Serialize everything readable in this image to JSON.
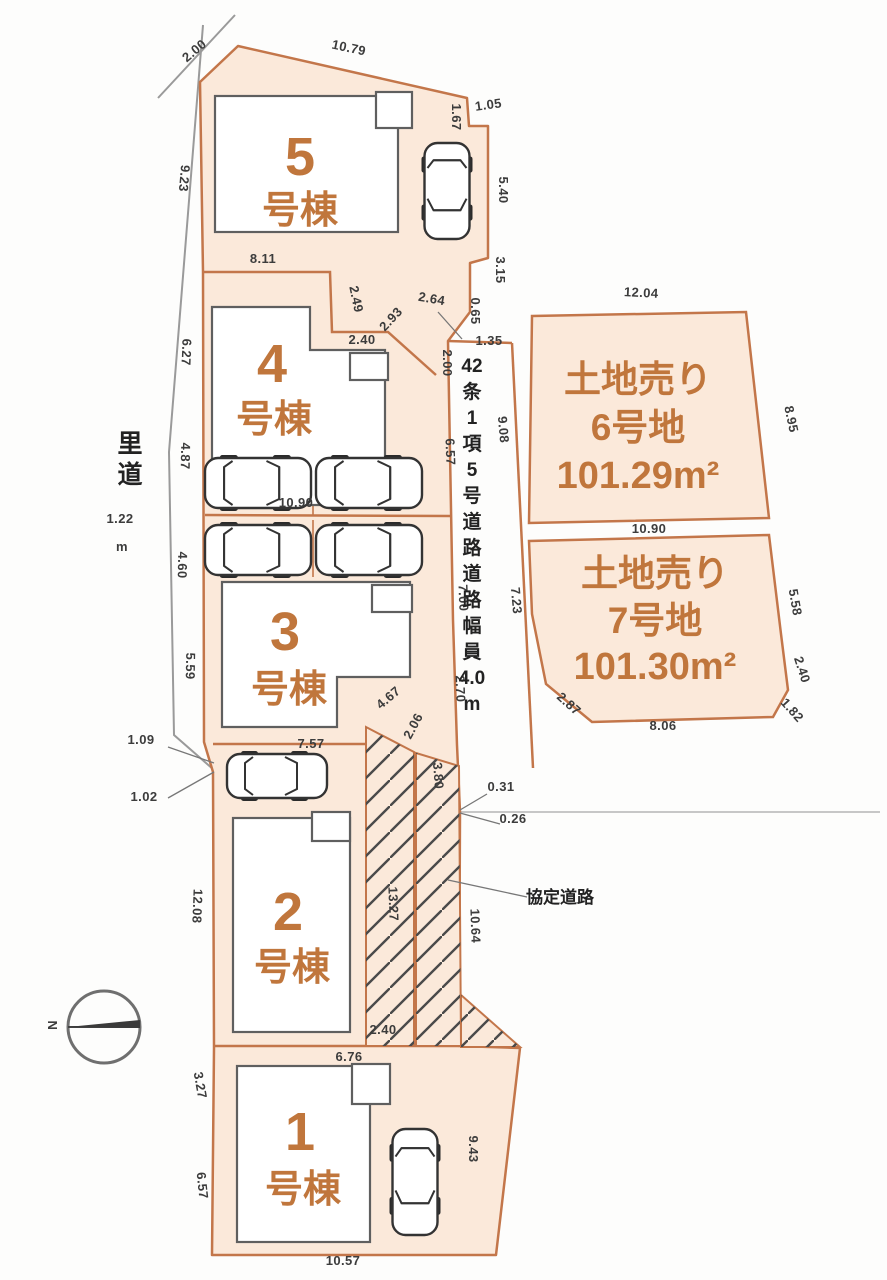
{
  "plan": {
    "title": "土地区画図",
    "north_label": "N",
    "colors": {
      "parcel_fill": "#fbe9da",
      "parcel_stroke": "#c3764a",
      "building_stroke": "#5f5f5f",
      "dim_text": "#3c3c3c",
      "lot_text": "#c0763c",
      "hatch_line": "#4a4a4a",
      "gray_line": "#9a9a9a"
    }
  },
  "satodou": {
    "chars": [
      "里",
      "道"
    ],
    "width_value": "1.22",
    "unit": "m"
  },
  "road": {
    "chars": [
      "42",
      "条",
      "1",
      "項",
      "5",
      "号",
      "道",
      "路",
      "道",
      "路",
      "幅",
      "員",
      "4.0",
      "m"
    ],
    "x": 472,
    "y_start": 372,
    "step": 26
  },
  "kyotei": {
    "label": "協定道路",
    "x": 560,
    "y": 903
  },
  "buildings": [
    {
      "num": "5",
      "suffix": "号棟",
      "nx": 300,
      "ny": 175,
      "sx": 300,
      "sy": 223
    },
    {
      "num": "4",
      "suffix": "号棟",
      "nx": 272,
      "ny": 382,
      "sx": 274,
      "sy": 432
    },
    {
      "num": "3",
      "suffix": "号棟",
      "nx": 285,
      "ny": 650,
      "sx": 289,
      "sy": 702
    },
    {
      "num": "2",
      "suffix": "号棟",
      "nx": 288,
      "ny": 930,
      "sx": 292,
      "sy": 980
    },
    {
      "num": "1",
      "suffix": "号棟",
      "nx": 300,
      "ny": 1150,
      "sx": 303,
      "sy": 1202
    }
  ],
  "land_lots": [
    {
      "name": "lot-6",
      "lines": [
        "土地売り",
        "6号地",
        "101.29m²"
      ],
      "cx": 638,
      "ys": [
        392,
        440,
        488
      ]
    },
    {
      "name": "lot-7",
      "lines": [
        "土地売り",
        "7号地",
        "101.30m²"
      ],
      "cx": 655,
      "ys": [
        586,
        633,
        679
      ]
    }
  ],
  "dimensions": [
    {
      "t": "2.00",
      "x": 197,
      "y": 54,
      "r": -40
    },
    {
      "t": "10.79",
      "x": 348,
      "y": 52,
      "r": 12
    },
    {
      "t": "1.67",
      "x": 452,
      "y": 117,
      "r": 90
    },
    {
      "t": "1.05",
      "x": 489,
      "y": 109,
      "r": -8
    },
    {
      "t": "5.40",
      "x": 499,
      "y": 190,
      "r": 90
    },
    {
      "t": "3.15",
      "x": 496,
      "y": 270,
      "r": 90
    },
    {
      "t": "0.65",
      "x": 471,
      "y": 311,
      "r": 90
    },
    {
      "t": "2.64",
      "x": 431,
      "y": 303,
      "r": 10
    },
    {
      "t": "1.35",
      "x": 489,
      "y": 345,
      "r": 0
    },
    {
      "t": "2.00",
      "x": 443,
      "y": 363,
      "r": 90
    },
    {
      "t": "8.11",
      "x": 263,
      "y": 263,
      "r": 0
    },
    {
      "t": "2.49",
      "x": 352,
      "y": 300,
      "r": 78
    },
    {
      "t": "2.93",
      "x": 394,
      "y": 322,
      "r": -47
    },
    {
      "t": "2.40",
      "x": 362,
      "y": 344,
      "r": 0
    },
    {
      "t": "9.23",
      "x": 180,
      "y": 178,
      "r": 95
    },
    {
      "t": "6.27",
      "x": 182,
      "y": 352,
      "r": 92
    },
    {
      "t": "4.87",
      "x": 181,
      "y": 456,
      "r": 91
    },
    {
      "t": "4.60",
      "x": 178,
      "y": 565,
      "r": 91
    },
    {
      "t": "5.59",
      "x": 186,
      "y": 666,
      "r": 91
    },
    {
      "t": "10.90",
      "x": 296,
      "y": 507,
      "r": 0
    },
    {
      "t": "6.57",
      "x": 446,
      "y": 452,
      "r": 88
    },
    {
      "t": "9.08",
      "x": 499,
      "y": 430,
      "r": 85
    },
    {
      "t": "7.00",
      "x": 459,
      "y": 598,
      "r": 88
    },
    {
      "t": "7.23",
      "x": 512,
      "y": 601,
      "r": 85
    },
    {
      "t": "2.70",
      "x": 456,
      "y": 689,
      "r": 88
    },
    {
      "t": "1.09",
      "x": 141,
      "y": 744,
      "r": 0
    },
    {
      "t": "1.02",
      "x": 144,
      "y": 801,
      "r": 0
    },
    {
      "t": "7.57",
      "x": 311,
      "y": 748,
      "r": 0
    },
    {
      "t": "4.67",
      "x": 391,
      "y": 701,
      "r": -40
    },
    {
      "t": "2.06",
      "x": 417,
      "y": 728,
      "r": -62
    },
    {
      "t": "3.80",
      "x": 434,
      "y": 776,
      "r": 86
    },
    {
      "t": "0.31",
      "x": 501,
      "y": 791,
      "r": 0
    },
    {
      "t": "0.26",
      "x": 513,
      "y": 823,
      "r": 0
    },
    {
      "t": "13.27",
      "x": 389,
      "y": 904,
      "r": 88
    },
    {
      "t": "10.64",
      "x": 471,
      "y": 926,
      "r": 88
    },
    {
      "t": "12.08",
      "x": 193,
      "y": 906,
      "r": 92
    },
    {
      "t": "2.40",
      "x": 383,
      "y": 1034,
      "r": 0
    },
    {
      "t": "6.76",
      "x": 349,
      "y": 1061,
      "r": 0
    },
    {
      "t": "3.27",
      "x": 196,
      "y": 1086,
      "r": 80
    },
    {
      "t": "6.57",
      "x": 198,
      "y": 1186,
      "r": 84
    },
    {
      "t": "9.43",
      "x": 469,
      "y": 1149,
      "r": 90
    },
    {
      "t": "10.57",
      "x": 343,
      "y": 1265,
      "r": 0
    },
    {
      "t": "12.04",
      "x": 641,
      "y": 297,
      "r": 3
    },
    {
      "t": "8.95",
      "x": 787,
      "y": 420,
      "r": 78
    },
    {
      "t": "10.90",
      "x": 649,
      "y": 533,
      "r": 0
    },
    {
      "t": "5.58",
      "x": 791,
      "y": 603,
      "r": 80
    },
    {
      "t": "2.40",
      "x": 798,
      "y": 671,
      "r": 72
    },
    {
      "t": "1.82",
      "x": 789,
      "y": 713,
      "r": 48
    },
    {
      "t": "8.06",
      "x": 663,
      "y": 730,
      "r": 0
    },
    {
      "t": "2.87",
      "x": 566,
      "y": 707,
      "r": 42
    }
  ]
}
